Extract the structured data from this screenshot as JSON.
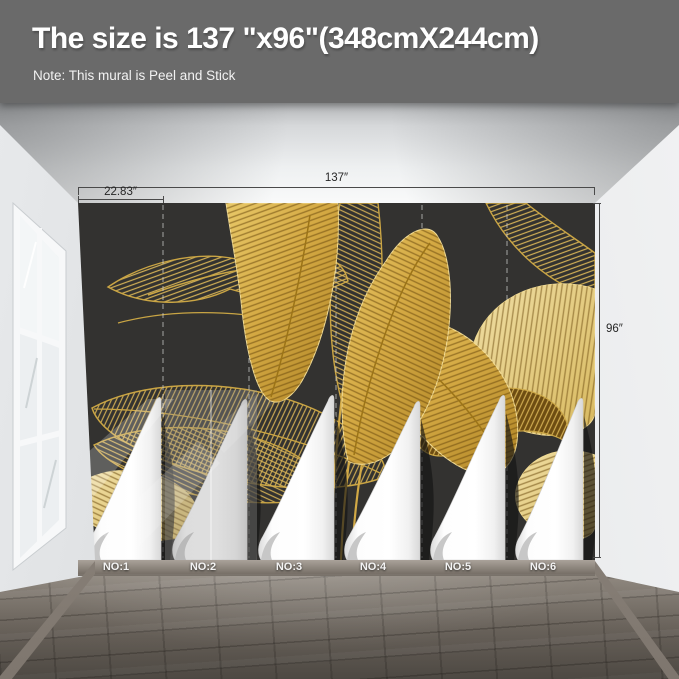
{
  "header": {
    "title": "The size is 137 \"x96\"(348cmX244cm)",
    "note": "Note: This mural is Peel and Stick"
  },
  "dimensions": {
    "total_width": "137″",
    "first_panel_width": "22.83″",
    "height": "96″"
  },
  "panels": [
    {
      "label": "NO:1"
    },
    {
      "label": "NO:2"
    },
    {
      "label": "NO:3"
    },
    {
      "label": "NO:4"
    },
    {
      "label": "NO:5"
    },
    {
      "label": "NO:6"
    }
  ],
  "colors": {
    "header_bg": "#6a6a6a",
    "mural_background": "#333230",
    "leaf_gold": "#d4a943",
    "leaf_gold_light": "#ecd489",
    "leaf_line_gold": "#caa544",
    "wall_left": "#d6d8da",
    "wall_right": "#e8eaec",
    "floor_wood": "#8b8379",
    "baseboard": "#968e85",
    "dimension_line": "#4a4a4a",
    "peel_paper": "#ffffff"
  }
}
